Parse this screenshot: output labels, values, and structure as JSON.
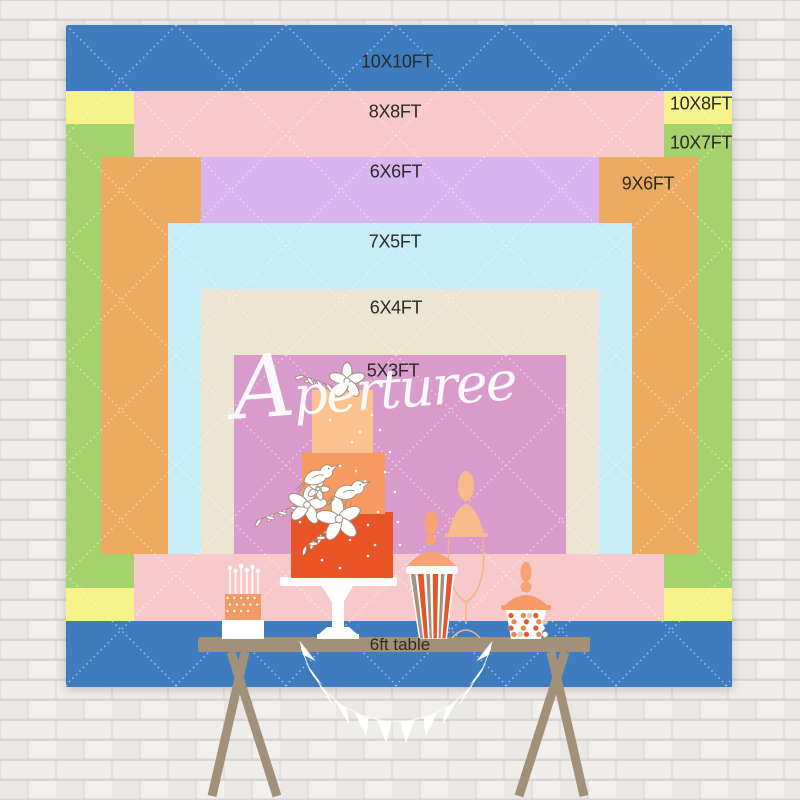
{
  "watermark": {
    "text": "Aperturee"
  },
  "backdrop": {
    "pattern": "diamond-quilt",
    "sizes": [
      {
        "label": "10X10FT",
        "width_ft": 10,
        "height_ft": 10,
        "color": "#3f7cbf"
      },
      {
        "label": "10X8FT",
        "width_ft": 10,
        "height_ft": 8,
        "color": "#f7f38b"
      },
      {
        "label": "10X7FT",
        "width_ft": 10,
        "height_ft": 7,
        "color": "#a4d36d"
      },
      {
        "label": "8X8FT",
        "width_ft": 8,
        "height_ft": 8,
        "color": "#f7c9cb"
      },
      {
        "label": "9X6FT",
        "width_ft": 9,
        "height_ft": 6,
        "color": "#edaa61"
      },
      {
        "label": "6X6FT",
        "width_ft": 6,
        "height_ft": 6,
        "color": "#d8b5ee"
      },
      {
        "label": "7X5FT",
        "width_ft": 7,
        "height_ft": 5,
        "color": "#c9ecf9"
      },
      {
        "label": "6X4FT",
        "width_ft": 6,
        "height_ft": 4,
        "color": "#ece5d2"
      },
      {
        "label": "5X3FT",
        "width_ft": 5,
        "height_ft": 3,
        "color": "#d89bcb"
      }
    ]
  },
  "table": {
    "label": "6ft table",
    "color": "#a29078"
  },
  "scene": {
    "wall": "white painted brick"
  }
}
